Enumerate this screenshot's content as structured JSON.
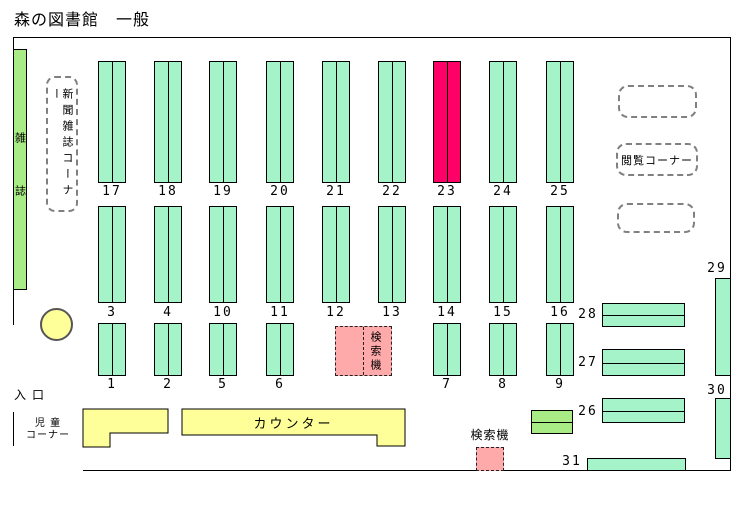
{
  "title": "森の図書館　一般",
  "colors": {
    "shelf": "#a5f3c8",
    "shelf_alt": "#a9ec85",
    "highlight": "#ff0066",
    "counter": "#ffff99",
    "search": "#ffaaaa"
  },
  "labels": {
    "magazines": "雑誌",
    "newspaper_corner": "新聞雑誌コーナー",
    "browsing_corner": "閲覧コーナー",
    "entrance": "入口",
    "children_corner_line1": "児 童",
    "children_corner_line2": "コーナー",
    "counter": "カウンター",
    "search_machine_mid": "検索機",
    "search_machine_bottom": "検索機"
  },
  "shelves": {
    "row1": [
      "17",
      "18",
      "19",
      "20",
      "21",
      "22",
      "23",
      "24",
      "25"
    ],
    "row1_highlight": "23",
    "row2": [
      "3",
      "4",
      "10",
      "11",
      "12",
      "13",
      "14",
      "15",
      "16"
    ],
    "row3": [
      "1",
      "2",
      "5",
      "6",
      "7",
      "8",
      "9"
    ],
    "right": {
      "s26": "26",
      "s27": "27",
      "s28": "28",
      "s29": "29",
      "s30": "30",
      "s31": "31"
    }
  }
}
